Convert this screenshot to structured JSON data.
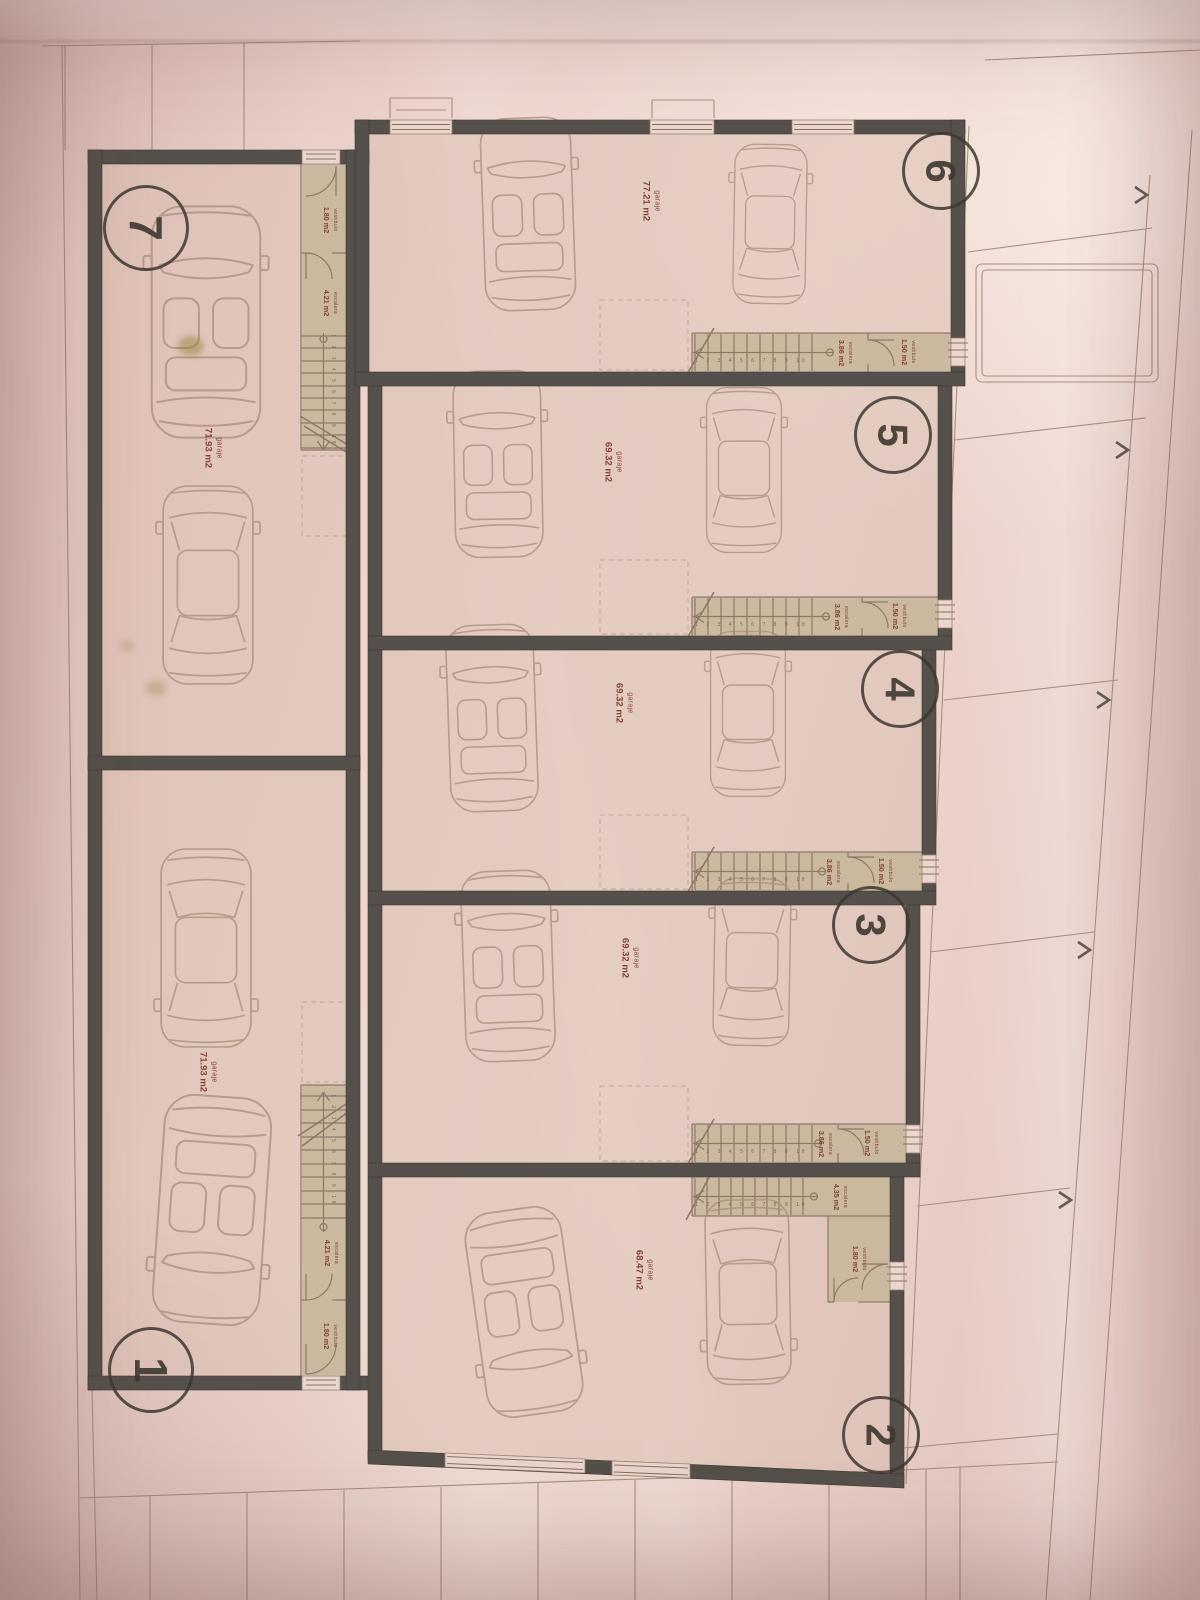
{
  "title": "Garage level floor plan (photographed drawing)",
  "plan": {
    "colors": {
      "paper": "#ecd3cc",
      "wall": "#55504b",
      "stair_room": "#c7b69a",
      "floor": "#dcc0b4",
      "ink": "#9c8273",
      "label_red": "#7c362b"
    },
    "icons": {
      "direction_arrow": "chevron-right",
      "door_symbol": "triple-bar",
      "car_types": [
        "car-convertible",
        "car-sedan"
      ]
    },
    "stair_tread_sequence": "1 2 3 4 5 6 7 8 9 10",
    "units": [
      {
        "number": "7",
        "label": "garaje",
        "area": "71.93 m2",
        "stair": {
          "label": "escalera",
          "area": "4.21 m2"
        },
        "vestibule": {
          "label": "vestibulo",
          "area": "1.80 m2"
        }
      },
      {
        "number": "6",
        "label": "garaje",
        "area": "77.21 m2",
        "stair": {
          "label": "escalera",
          "area": "3.86 m2"
        },
        "vestibule": {
          "label": "vestibulo",
          "area": "1.50 m2"
        }
      },
      {
        "number": "5",
        "label": "garaje",
        "area": "69.32 m2",
        "stair": {
          "label": "escalera",
          "area": "3.86 m2"
        },
        "vestibule": {
          "label": "vestibulo",
          "area": "1.50 m2"
        }
      },
      {
        "number": "4",
        "label": "garaje",
        "area": "69.32 m2",
        "stair": {
          "label": "escalera",
          "area": "3.86 m2"
        },
        "vestibule": {
          "label": "vestibulo",
          "area": "1.50 m2"
        }
      },
      {
        "number": "3",
        "label": "garaje",
        "area": "69.32 m2",
        "stair": {
          "label": "escalera",
          "area": "3.86 m2"
        },
        "vestibule": {
          "label": "vestibulo",
          "area": "1.50 m2"
        }
      },
      {
        "number": "2",
        "label": "garaje",
        "area": "68.47 m2",
        "stair": {
          "label": "escalera",
          "area": "4.35 m2"
        },
        "vestibule": {
          "label": "vestibulo",
          "area": "1.80 m2"
        }
      },
      {
        "number": "1",
        "label": "garaje",
        "area": "71.93 m2",
        "stair": {
          "label": "escalera",
          "area": "4.21 m2"
        },
        "vestibule": {
          "label": "vestibulo",
          "area": "1.80 m2"
        }
      }
    ]
  }
}
